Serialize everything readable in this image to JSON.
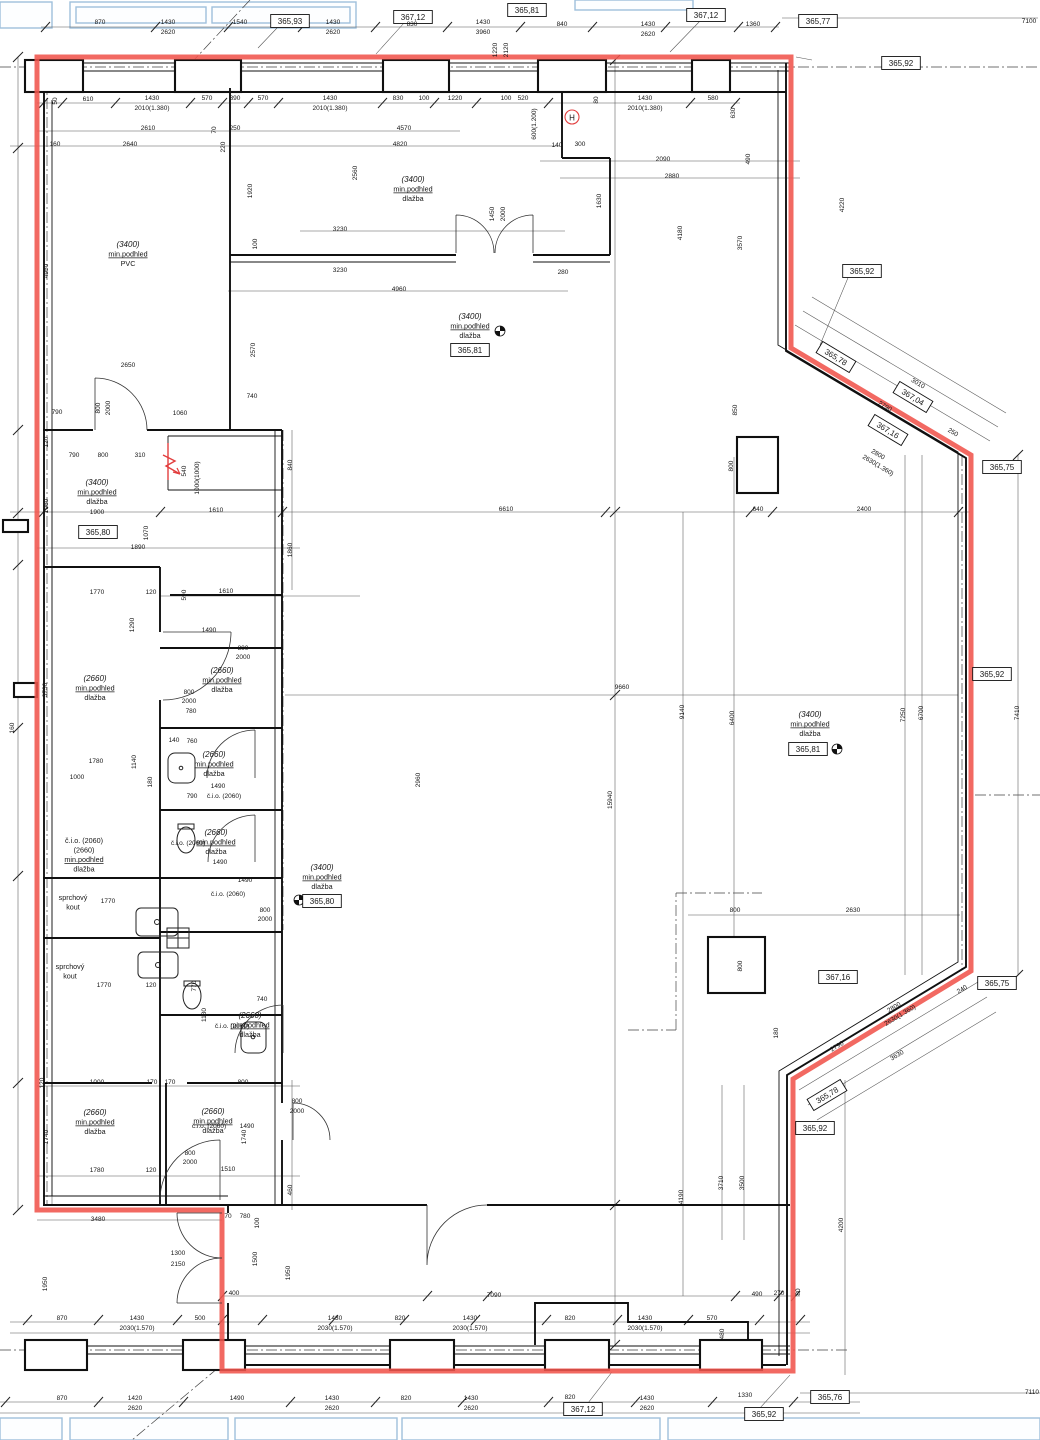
{
  "drawing": {
    "type": "architectural-floor-plan",
    "boundary_color": "#f0544c",
    "hydrant_symbol": "H"
  },
  "dims": [
    [
      100,
      24,
      "870"
    ],
    [
      168,
      24,
      "1430"
    ],
    [
      168,
      34,
      "2620"
    ],
    [
      240,
      24,
      "1540"
    ],
    [
      333,
      24,
      "1430"
    ],
    [
      333,
      34,
      "2620"
    ],
    [
      412,
      26,
      "830"
    ],
    [
      483,
      24,
      "1430"
    ],
    [
      483,
      34,
      "3960"
    ],
    [
      497,
      50,
      "1220",
      90
    ],
    [
      508,
      50,
      "2120",
      90
    ],
    [
      562,
      26,
      "840"
    ],
    [
      648,
      26,
      "1430"
    ],
    [
      648,
      36,
      "2620"
    ],
    [
      753,
      26,
      "1360"
    ],
    [
      1029,
      23,
      "7100"
    ],
    [
      57,
      101,
      "50",
      90
    ],
    [
      88,
      101,
      "610"
    ],
    [
      152,
      100,
      "1430"
    ],
    [
      152,
      110,
      "2010(1.380)"
    ],
    [
      207,
      100,
      "570"
    ],
    [
      235,
      100,
      "390"
    ],
    [
      263,
      100,
      "570"
    ],
    [
      330,
      100,
      "1430"
    ],
    [
      330,
      110,
      "2010(1.380)"
    ],
    [
      398,
      100,
      "830"
    ],
    [
      424,
      100,
      "100"
    ],
    [
      455,
      100,
      "1220"
    ],
    [
      506,
      100,
      "100"
    ],
    [
      523,
      100,
      "520"
    ],
    [
      536,
      124,
      "600(1.200)",
      90
    ],
    [
      598,
      100,
      "80",
      90
    ],
    [
      645,
      100,
      "1430"
    ],
    [
      645,
      110,
      "2010(1.380)"
    ],
    [
      713,
      100,
      "580"
    ],
    [
      735,
      113,
      "630",
      90
    ],
    [
      148,
      130,
      "2610"
    ],
    [
      216,
      130,
      "70",
      90
    ],
    [
      235,
      130,
      "250"
    ],
    [
      404,
      130,
      "4570"
    ],
    [
      55,
      146,
      "160"
    ],
    [
      130,
      146,
      "2640"
    ],
    [
      225,
      147,
      "220",
      90
    ],
    [
      400,
      146,
      "4820"
    ],
    [
      557,
      147,
      "140"
    ],
    [
      580,
      146,
      "300"
    ],
    [
      663,
      161,
      "2090"
    ],
    [
      750,
      159,
      "490",
      90
    ],
    [
      672,
      178,
      "2880"
    ],
    [
      357,
      173,
      "2560",
      90
    ],
    [
      252,
      191,
      "1920",
      90
    ],
    [
      494,
      214,
      "1450",
      90
    ],
    [
      505,
      214,
      "2000",
      90
    ],
    [
      340,
      231,
      "3230"
    ],
    [
      257,
      244,
      "100",
      90
    ],
    [
      340,
      272,
      "3230"
    ],
    [
      399,
      291,
      "4960"
    ],
    [
      563,
      274,
      "280"
    ],
    [
      601,
      201,
      "1630",
      90
    ],
    [
      682,
      233,
      "4180",
      90
    ],
    [
      742,
      243,
      "3570",
      90
    ],
    [
      844,
      205,
      "4220",
      90
    ],
    [
      737,
      410,
      "850",
      90
    ],
    [
      128,
      367,
      "2650"
    ],
    [
      57,
      414,
      "790"
    ],
    [
      100,
      408,
      "800",
      90
    ],
    [
      110,
      408,
      "2000",
      90
    ],
    [
      180,
      415,
      "1060"
    ],
    [
      252,
      398,
      "740"
    ],
    [
      255,
      350,
      "2570",
      90
    ],
    [
      48,
      442,
      "120",
      90
    ],
    [
      74,
      457,
      "790"
    ],
    [
      103,
      457,
      "800"
    ],
    [
      140,
      457,
      "310"
    ],
    [
      186,
      471,
      "540",
      90
    ],
    [
      199,
      478,
      "1000(1000)",
      90
    ],
    [
      292,
      465,
      "840",
      90
    ],
    [
      216,
      512,
      "1610"
    ],
    [
      506,
      511,
      "6610"
    ],
    [
      758,
      511,
      "640"
    ],
    [
      864,
      511,
      "2400"
    ],
    [
      97,
      514,
      "1900"
    ],
    [
      138,
      549,
      "1890"
    ],
    [
      148,
      533,
      "1070",
      90
    ],
    [
      48,
      506,
      "1960",
      90
    ],
    [
      292,
      550,
      "1860",
      90
    ],
    [
      48,
      271,
      "4950",
      90
    ],
    [
      97,
      594,
      "1770"
    ],
    [
      151,
      594,
      "120"
    ],
    [
      186,
      595,
      "590",
      90
    ],
    [
      226,
      593,
      "1610"
    ],
    [
      134,
      625,
      "1290",
      90
    ],
    [
      209,
      632,
      "1490"
    ],
    [
      243,
      650,
      "800"
    ],
    [
      243,
      659,
      "2000"
    ],
    [
      189,
      694,
      "800"
    ],
    [
      189,
      703,
      "2000"
    ],
    [
      191,
      713,
      "780"
    ],
    [
      47,
      690,
      "3730",
      90
    ],
    [
      14,
      728,
      "160",
      90
    ],
    [
      420,
      780,
      "2960",
      90
    ],
    [
      622,
      689,
      "9660"
    ],
    [
      684,
      712,
      "9140",
      90
    ],
    [
      734,
      718,
      "6400",
      90
    ],
    [
      905,
      715,
      "7250",
      90
    ],
    [
      923,
      713,
      "6700",
      90
    ],
    [
      1019,
      713,
      "7410",
      90
    ],
    [
      612,
      800,
      "15940",
      90
    ],
    [
      77,
      779,
      "1000"
    ],
    [
      96,
      763,
      "1780"
    ],
    [
      136,
      762,
      "1140",
      90
    ],
    [
      152,
      782,
      "180",
      90
    ],
    [
      174,
      742,
      "140"
    ],
    [
      192,
      743,
      "760"
    ],
    [
      218,
      788,
      "1490"
    ],
    [
      192,
      798,
      "790"
    ],
    [
      224,
      798,
      "č.i.o. (2060)"
    ],
    [
      188,
      845,
      "č.i.o. (2060)"
    ],
    [
      220,
      864,
      "1490"
    ],
    [
      245,
      882,
      "1490"
    ],
    [
      228,
      896,
      "č.i.o. (2060)"
    ],
    [
      265,
      912,
      "800"
    ],
    [
      265,
      921,
      "2000"
    ],
    [
      108,
      903,
      "1770"
    ],
    [
      104,
      987,
      "1770"
    ],
    [
      151,
      987,
      "120"
    ],
    [
      196,
      986,
      "770",
      90
    ],
    [
      262,
      1001,
      "740"
    ],
    [
      206,
      1015,
      "1130",
      90
    ],
    [
      232,
      1028,
      "č.i.o. (2060)"
    ],
    [
      209,
      1128,
      "č.i.o. (2060)"
    ],
    [
      247,
      1128,
      "1490"
    ],
    [
      853,
      912,
      "2630"
    ],
    [
      735,
      912,
      "800"
    ],
    [
      733,
      466,
      "800",
      90
    ],
    [
      742,
      966,
      "800",
      90
    ],
    [
      917,
      385,
      "3010",
      31
    ],
    [
      884,
      408,
      "2790",
      31
    ],
    [
      877,
      456,
      "2800",
      31
    ],
    [
      877,
      467,
      "2630(1.360)",
      31
    ],
    [
      952,
      434,
      "250",
      31
    ],
    [
      895,
      1009,
      "2800",
      -31
    ],
    [
      901,
      1017,
      "2630(1.360)",
      -31
    ],
    [
      838,
      1048,
      "2790",
      -31
    ],
    [
      898,
      1057,
      "3630",
      -31
    ],
    [
      963,
      991,
      "240",
      -31
    ],
    [
      778,
      1033,
      "180",
      90
    ],
    [
      97,
      1084,
      "1000"
    ],
    [
      152,
      1084,
      "170"
    ],
    [
      170,
      1084,
      "170"
    ],
    [
      243,
      1084,
      "800"
    ],
    [
      44,
      1083,
      "120",
      90
    ],
    [
      48,
      1137,
      "1740",
      90
    ],
    [
      246,
      1137,
      "1740",
      90
    ],
    [
      97,
      1172,
      "1780"
    ],
    [
      151,
      1172,
      "120"
    ],
    [
      228,
      1171,
      "1510"
    ],
    [
      190,
      1155,
      "800"
    ],
    [
      190,
      1164,
      "2000"
    ],
    [
      297,
      1103,
      "800"
    ],
    [
      297,
      1113,
      "2000"
    ],
    [
      98,
      1221,
      "3480"
    ],
    [
      178,
      1255,
      "1300"
    ],
    [
      178,
      1266,
      "2150"
    ],
    [
      47,
      1284,
      "1950",
      90
    ],
    [
      290,
      1273,
      "1950",
      90
    ],
    [
      234,
      1295,
      "400"
    ],
    [
      228,
      1218,
      "70"
    ],
    [
      245,
      1218,
      "780"
    ],
    [
      259,
      1223,
      "100",
      90
    ],
    [
      257,
      1259,
      "1500",
      90
    ],
    [
      292,
      1190,
      "460",
      90
    ],
    [
      494,
      1297,
      "7090"
    ],
    [
      62,
      1320,
      "870"
    ],
    [
      137,
      1320,
      "1430"
    ],
    [
      137,
      1330,
      "2030(1.570)"
    ],
    [
      200,
      1320,
      "500"
    ],
    [
      335,
      1320,
      "1430"
    ],
    [
      335,
      1330,
      "2030(1.570)"
    ],
    [
      400,
      1320,
      "820"
    ],
    [
      470,
      1320,
      "1430"
    ],
    [
      470,
      1330,
      "2030(1.570)"
    ],
    [
      570,
      1320,
      "820"
    ],
    [
      645,
      1320,
      "1430"
    ],
    [
      645,
      1330,
      "2030(1.570)"
    ],
    [
      712,
      1320,
      "570"
    ],
    [
      724,
      1334,
      "480",
      90
    ],
    [
      757,
      1296,
      "490"
    ],
    [
      779,
      1295,
      "270"
    ],
    [
      800,
      1292,
      "80",
      90
    ],
    [
      683,
      1197,
      "4190",
      90
    ],
    [
      723,
      1183,
      "3710",
      90
    ],
    [
      744,
      1183,
      "3500",
      90
    ],
    [
      843,
      1225,
      "4200",
      90
    ],
    [
      62,
      1400,
      "870"
    ],
    [
      135,
      1400,
      "1420"
    ],
    [
      135,
      1410,
      "2620"
    ],
    [
      237,
      1400,
      "1490"
    ],
    [
      332,
      1400,
      "1430"
    ],
    [
      332,
      1410,
      "2620"
    ],
    [
      406,
      1400,
      "820"
    ],
    [
      471,
      1400,
      "1430"
    ],
    [
      471,
      1410,
      "2620"
    ],
    [
      570,
      1399,
      "820"
    ],
    [
      647,
      1400,
      "1430"
    ],
    [
      647,
      1410,
      "2620"
    ],
    [
      745,
      1397,
      "1330"
    ],
    [
      1032,
      1394,
      "7110"
    ]
  ],
  "rooms": [
    [
      128,
      247,
      [
        "(3400)",
        "min.podhled",
        "PVC"
      ]
    ],
    [
      413,
      182,
      [
        "(3400)",
        "min.podhled",
        "dlažba"
      ]
    ],
    [
      470,
      319,
      [
        "(3400)",
        "min.podhled",
        "dlažba"
      ]
    ],
    [
      97,
      485,
      [
        "(3400)",
        "min.podhled",
        "dlažba"
      ]
    ],
    [
      810,
      717,
      [
        "(3400)",
        "min.podhled",
        "dlažba"
      ]
    ],
    [
      322,
      870,
      [
        "(3400)",
        "min.podhled",
        "dlažba"
      ]
    ],
    [
      95,
      681,
      [
        "(2660)",
        "min.podhled",
        "dlažba"
      ]
    ],
    [
      222,
      673,
      [
        "(2660)",
        "min.podhled",
        "dlažba"
      ]
    ],
    [
      214,
      757,
      [
        "(2660)",
        "min.podhled",
        "dlažba"
      ]
    ],
    [
      84,
      843,
      [
        "č.i.o. (2060)",
        "(2660)",
        "min.podhled",
        "dlažba"
      ]
    ],
    [
      216,
      835,
      [
        "(2660)",
        "min.podhled",
        "dlažba"
      ]
    ],
    [
      250,
      1018,
      [
        "(2660)",
        "min.podhled",
        "dlažba"
      ]
    ],
    [
      95,
      1115,
      [
        "(2660)",
        "min.podhled",
        "dlažba"
      ]
    ],
    [
      213,
      1114,
      [
        "(2660)",
        "min.podhled",
        "dlažba"
      ]
    ],
    [
      73,
      900,
      [
        "sprchový",
        "kout"
      ]
    ],
    [
      70,
      969,
      [
        "sprchový",
        "kout"
      ]
    ]
  ],
  "elevations": [
    [
      290,
      21,
      "365,93"
    ],
    [
      413,
      17,
      "367,12"
    ],
    [
      527,
      10,
      "365,81"
    ],
    [
      706,
      15,
      "367,12"
    ],
    [
      818,
      21,
      "365,77"
    ],
    [
      901,
      63,
      "365,92"
    ],
    [
      862,
      271,
      "365,92"
    ],
    [
      836,
      357,
      "365,78",
      31
    ],
    [
      913,
      397,
      "367,04",
      31
    ],
    [
      888,
      430,
      "367,16",
      31
    ],
    [
      1002,
      467,
      "365,75"
    ],
    [
      992,
      674,
      "365,92"
    ],
    [
      997,
      983,
      "365,75"
    ],
    [
      838,
      977,
      "367,16"
    ],
    [
      827,
      1095,
      "365,78",
      -31
    ],
    [
      815,
      1128,
      "365,92"
    ],
    [
      583,
      1409,
      "367,12"
    ],
    [
      764,
      1414,
      "365,92"
    ],
    [
      830,
      1397,
      "365,76"
    ],
    [
      98,
      532,
      "365,80"
    ],
    [
      322,
      901,
      "365,80"
    ],
    [
      470,
      350,
      "365,81"
    ],
    [
      808,
      749,
      "365,81"
    ]
  ]
}
